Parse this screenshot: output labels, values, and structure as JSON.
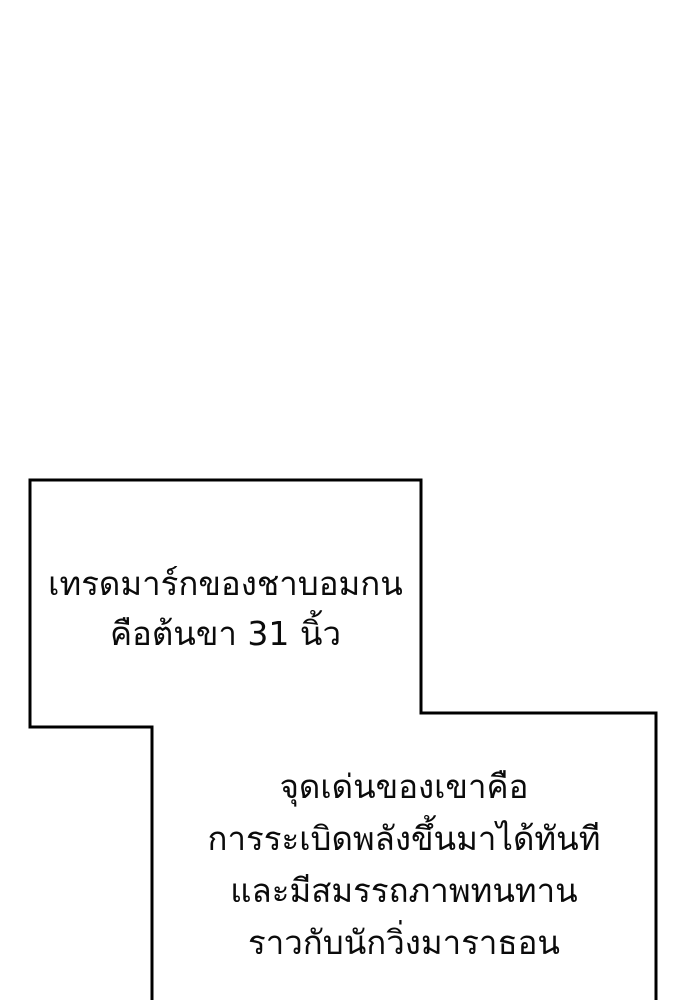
{
  "colors": {
    "background": "#ffffff",
    "outline": "#000000",
    "text": "#0b0b0b"
  },
  "speech_box_top": {
    "lines": [
      "เทรดมาร์กของชาบอมกน",
      "คือต้นขา 31 นิ้ว"
    ]
  },
  "speech_box_bottom": {
    "lines": [
      "จุดเด่นของเขาคือ",
      "การระเบิดพลังขึ้นมาได้ทันที",
      "และมีสมรรถภาพทนทาน",
      "ราวกับนักวิ่งมาราธอน"
    ]
  }
}
